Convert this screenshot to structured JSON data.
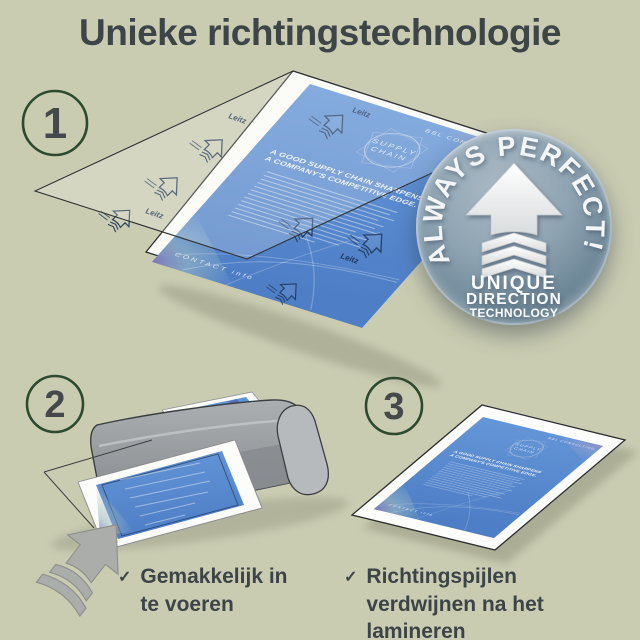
{
  "title": "Unieke richtingstechnologie",
  "steps": [
    "1",
    "2",
    "3"
  ],
  "badge": {
    "arc_text": "ALWAYS PERFECT!",
    "line1": "UNIQUE",
    "line2": "DIRECTION",
    "line3": "TECHNOLOGY"
  },
  "document": {
    "brand": "BBL CONSULTING",
    "emblem_line1": "SUPPLY",
    "emblem_line2": "CHAIN",
    "headline_line1": "A GOOD SUPPLY CHAIN SHARPENS",
    "headline_line2": "A COMPANY'S COMPETITIVE EDGE.",
    "footer": "CONTACT info"
  },
  "pouch": {
    "logo": "Leitz"
  },
  "checklist": [
    {
      "mark": "✓",
      "text": "Gemakkelijk in te voeren"
    },
    {
      "mark": "✓",
      "text": "Richtingspijlen verdwijnen na het lamineren"
    }
  ],
  "colors": {
    "background": "#caccb2",
    "title_text": "#3d4549",
    "step_circle_border": "#2c4a2e",
    "step_number": "#46494c",
    "badge_gray_blue": "#6a8494",
    "document_blue": "#5b8ed4",
    "accent_purple": "#8b7fc0",
    "machine_gray": "#999da0",
    "checklist_text": "#3c4448"
  }
}
